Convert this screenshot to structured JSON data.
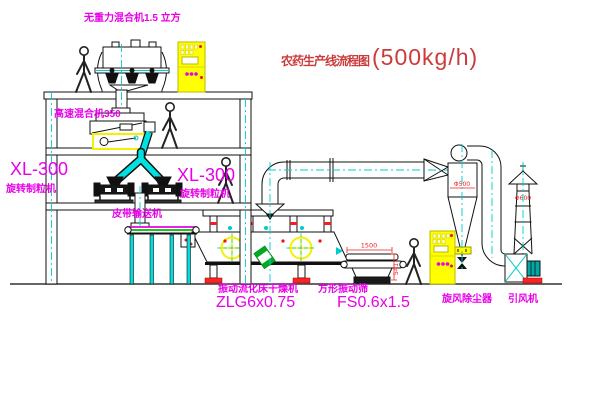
{
  "title": {
    "name_zh": "农药生产线流程图",
    "capacity": "(500kg/h)"
  },
  "equipment_labels": {
    "gravity_free_mixer": "无重力混合机1.5 立方",
    "high_speed_mixer": "高速混合机350",
    "granulator_left": {
      "model": "XL-300",
      "name": "旋转制粒机"
    },
    "granulator_right": {
      "model": "XL-300",
      "name": "旋转制粒机"
    },
    "belt_conveyor": "皮带输送机",
    "fluid_bed_dryer": {
      "name": "振动流化床干燥机",
      "model": "ZLG6x0.75"
    },
    "vibrating_sieve": {
      "name": "方形振动筛",
      "model": "FS0.6x1.5"
    },
    "cyclone_dust_collector": "旋风除尘器",
    "induced_draft_fan": "引风机"
  },
  "dimensions": {
    "sieve_length": "1500",
    "sieve_height": "541",
    "cyclone_diameter": "Φ500",
    "stack_diameter": "Φ600"
  },
  "colors": {
    "label_magenta": "#e800e8",
    "title_red": "#cc3b3b",
    "dimension_red": "#ee2222",
    "centerline_cyan": "#00cccc",
    "cabinet_yellow": "#ffff00",
    "conveyor_green": "#00bb00",
    "motor_teal": "#00a8a8",
    "base_red": "#ff2222"
  }
}
